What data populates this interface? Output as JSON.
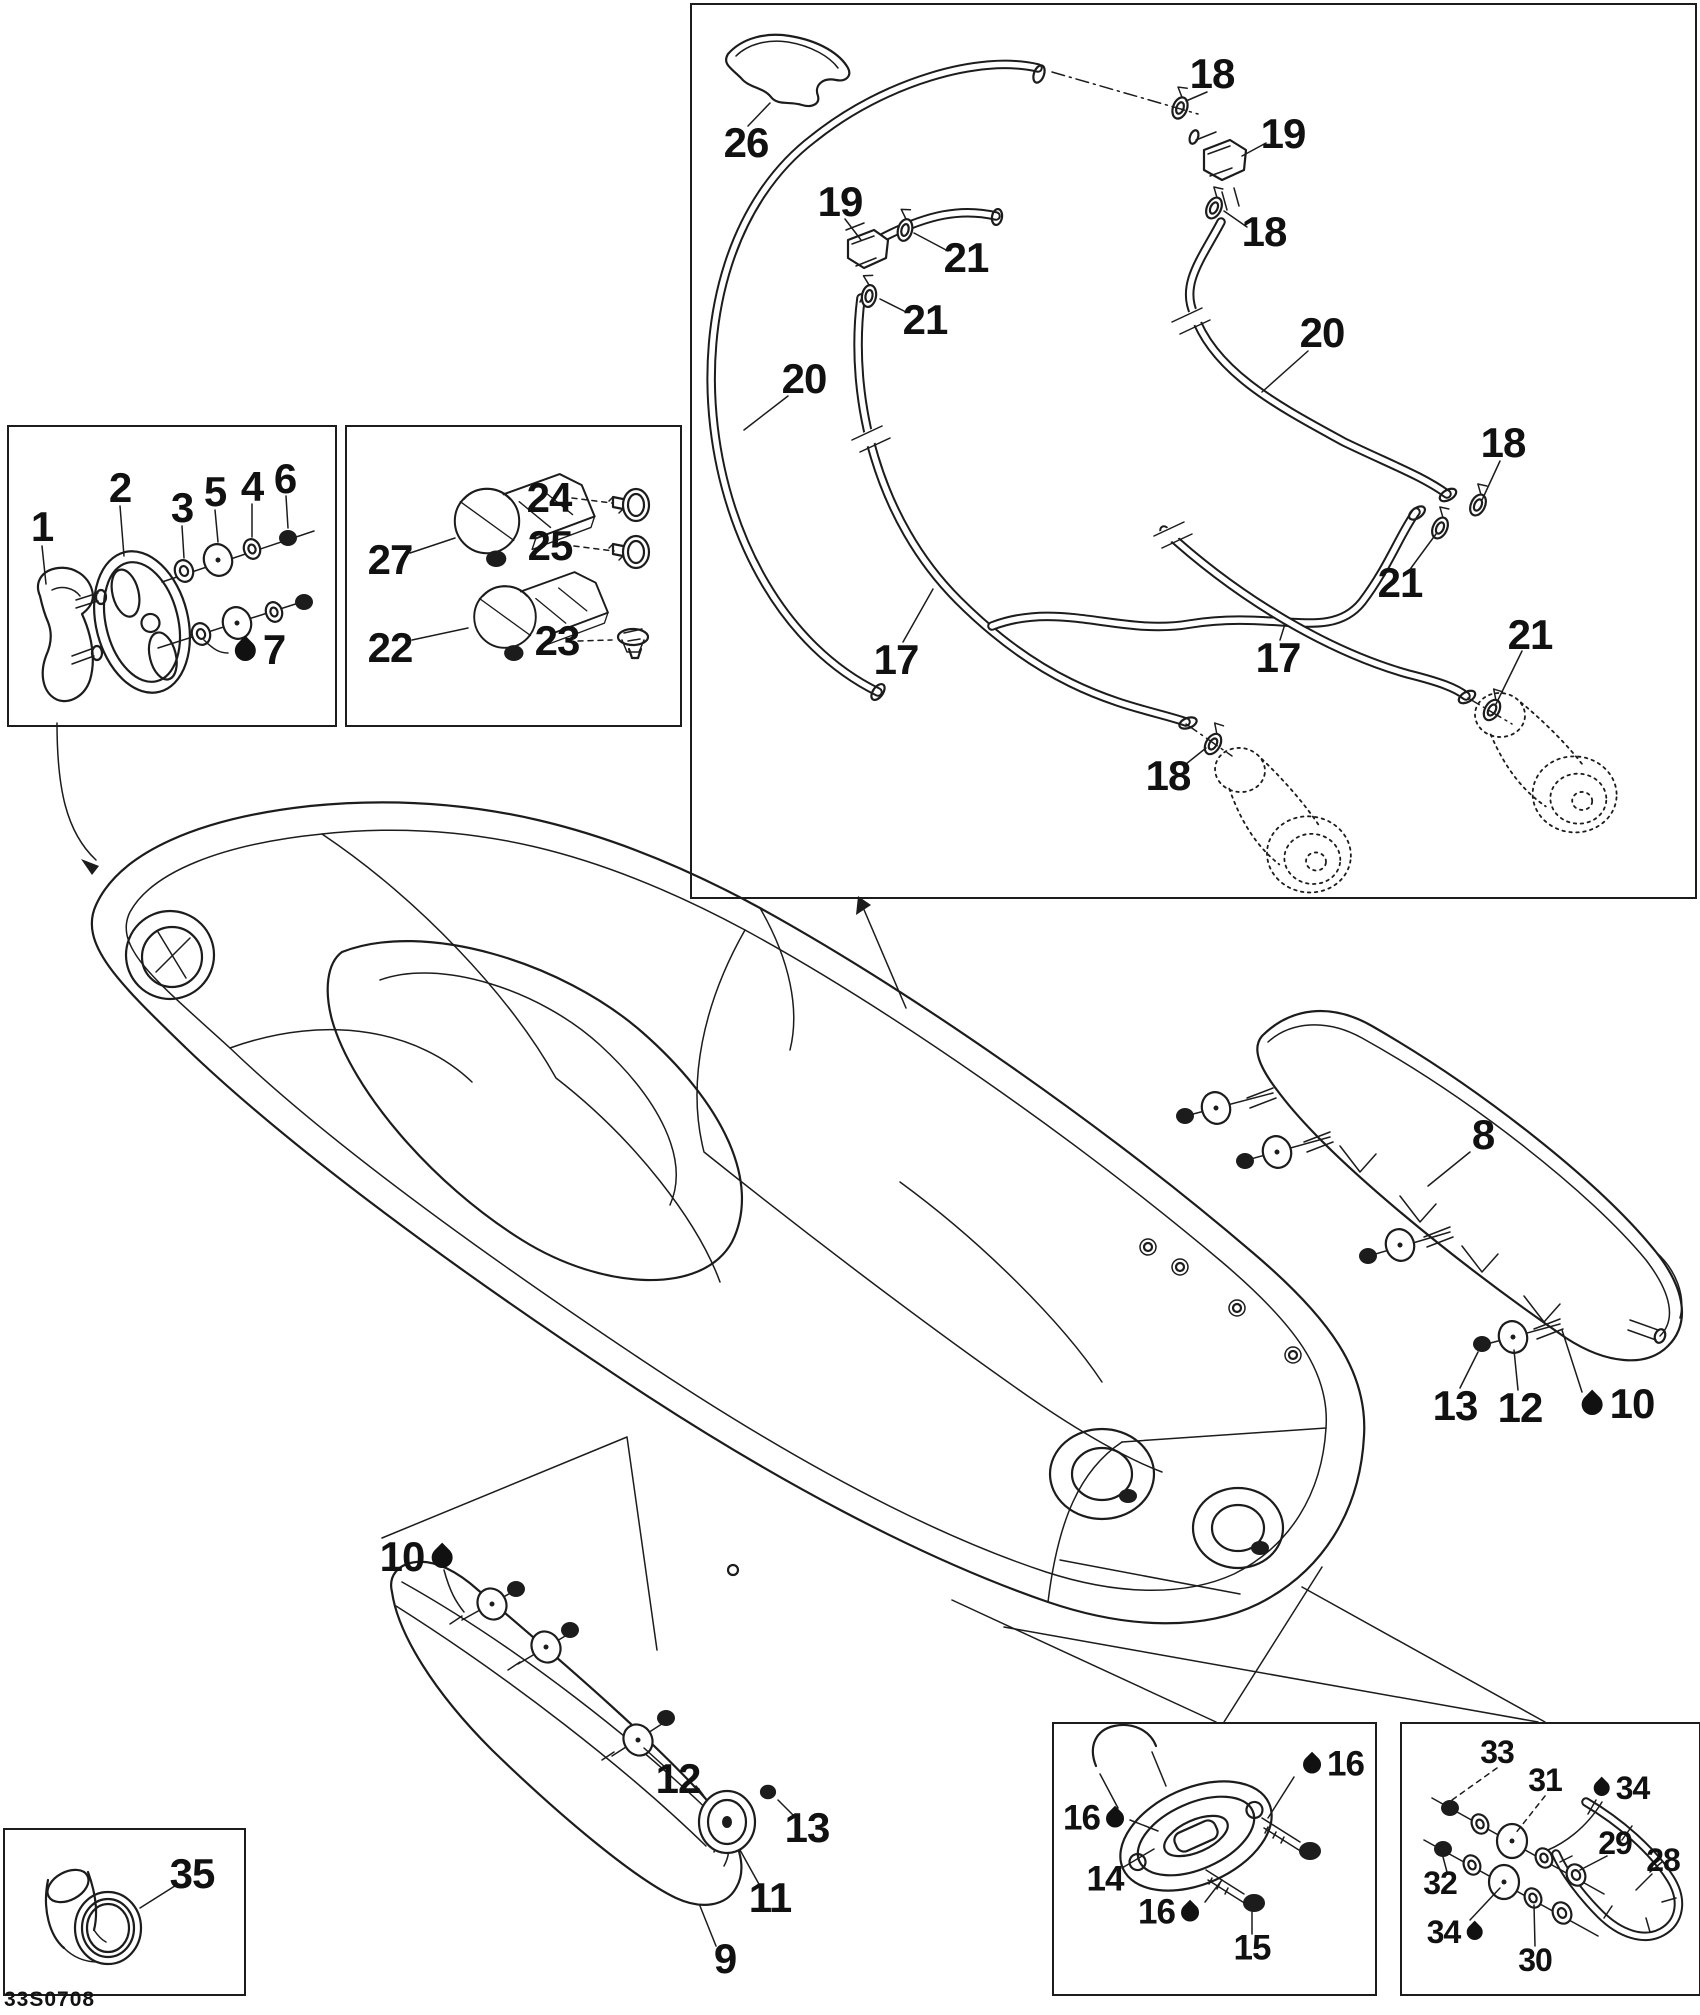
{
  "doc": {
    "code": "33S0708"
  },
  "colors": {
    "line": "#1c1c1c",
    "background": "#ffffff",
    "label": "#111111"
  },
  "legend": {
    "oil_drop_meaning": "lubricant-symbol"
  },
  "callouts": [
    {
      "label": "1",
      "x": 42,
      "y": 527,
      "size": "lg",
      "drop": "none"
    },
    {
      "label": "2",
      "x": 120,
      "y": 488,
      "size": "lg",
      "drop": "none"
    },
    {
      "label": "3",
      "x": 182,
      "y": 508,
      "size": "lg",
      "drop": "none"
    },
    {
      "label": "5",
      "x": 215,
      "y": 492,
      "size": "lg",
      "drop": "none"
    },
    {
      "label": "4",
      "x": 252,
      "y": 487,
      "size": "lg",
      "drop": "none"
    },
    {
      "label": "6",
      "x": 285,
      "y": 479,
      "size": "lg",
      "drop": "none"
    },
    {
      "label": "7",
      "x": 258,
      "y": 650,
      "size": "lg",
      "drop": "before"
    },
    {
      "label": "27",
      "x": 390,
      "y": 560,
      "size": "lg",
      "drop": "none"
    },
    {
      "label": "22",
      "x": 390,
      "y": 648,
      "size": "lg",
      "drop": "none"
    },
    {
      "label": "24",
      "x": 549,
      "y": 498,
      "size": "lg",
      "drop": "none"
    },
    {
      "label": "25",
      "x": 550,
      "y": 546,
      "size": "lg",
      "drop": "none"
    },
    {
      "label": "23",
      "x": 557,
      "y": 641,
      "size": "lg",
      "drop": "none"
    },
    {
      "label": "26",
      "x": 746,
      "y": 143,
      "size": "lg",
      "drop": "none"
    },
    {
      "label": "19",
      "x": 840,
      "y": 202,
      "size": "lg",
      "drop": "none"
    },
    {
      "label": "21",
      "x": 966,
      "y": 258,
      "size": "lg",
      "drop": "none"
    },
    {
      "label": "21",
      "x": 925,
      "y": 320,
      "size": "lg",
      "drop": "none"
    },
    {
      "label": "18",
      "x": 1212,
      "y": 74,
      "size": "lg",
      "drop": "none"
    },
    {
      "label": "19",
      "x": 1283,
      "y": 134,
      "size": "lg",
      "drop": "none"
    },
    {
      "label": "18",
      "x": 1264,
      "y": 232,
      "size": "lg",
      "drop": "none"
    },
    {
      "label": "20",
      "x": 804,
      "y": 379,
      "size": "lg",
      "drop": "none"
    },
    {
      "label": "20",
      "x": 1322,
      "y": 333,
      "size": "lg",
      "drop": "none"
    },
    {
      "label": "18",
      "x": 1503,
      "y": 443,
      "size": "lg",
      "drop": "none"
    },
    {
      "label": "21",
      "x": 1400,
      "y": 583,
      "size": "lg",
      "drop": "none"
    },
    {
      "label": "21",
      "x": 1530,
      "y": 635,
      "size": "lg",
      "drop": "none"
    },
    {
      "label": "17",
      "x": 896,
      "y": 660,
      "size": "lg",
      "drop": "none"
    },
    {
      "label": "17",
      "x": 1278,
      "y": 658,
      "size": "lg",
      "drop": "none"
    },
    {
      "label": "18",
      "x": 1168,
      "y": 776,
      "size": "lg",
      "drop": "none"
    },
    {
      "label": "8",
      "x": 1483,
      "y": 1135,
      "size": "lg",
      "drop": "none"
    },
    {
      "label": "13",
      "x": 1455,
      "y": 1406,
      "size": "lg",
      "drop": "none"
    },
    {
      "label": "12",
      "x": 1520,
      "y": 1408,
      "size": "lg",
      "drop": "none"
    },
    {
      "label": "10",
      "x": 1616,
      "y": 1404,
      "size": "lg",
      "drop": "before"
    },
    {
      "label": "10",
      "x": 418,
      "y": 1557,
      "size": "lg",
      "drop": "after"
    },
    {
      "label": "12",
      "x": 678,
      "y": 1779,
      "size": "lg",
      "drop": "none"
    },
    {
      "label": "13",
      "x": 807,
      "y": 1828,
      "size": "lg",
      "drop": "none"
    },
    {
      "label": "11",
      "x": 770,
      "y": 1898,
      "size": "lg",
      "drop": "none"
    },
    {
      "label": "9",
      "x": 725,
      "y": 1959,
      "size": "lg",
      "drop": "none"
    },
    {
      "label": "35",
      "x": 192,
      "y": 1874,
      "size": "lg",
      "drop": "none"
    },
    {
      "label": "16",
      "x": 1095,
      "y": 1818,
      "size": "md",
      "drop": "after"
    },
    {
      "label": "14",
      "x": 1105,
      "y": 1879,
      "size": "md",
      "drop": "none"
    },
    {
      "label": "16",
      "x": 1332,
      "y": 1764,
      "size": "md",
      "drop": "before"
    },
    {
      "label": "16",
      "x": 1170,
      "y": 1912,
      "size": "md",
      "drop": "after"
    },
    {
      "label": "15",
      "x": 1252,
      "y": 1948,
      "size": "md",
      "drop": "none"
    },
    {
      "label": "33",
      "x": 1497,
      "y": 1752,
      "size": "sm",
      "drop": "none"
    },
    {
      "label": "31",
      "x": 1545,
      "y": 1780,
      "size": "sm",
      "drop": "none"
    },
    {
      "label": "34",
      "x": 1620,
      "y": 1788,
      "size": "sm",
      "drop": "before"
    },
    {
      "label": "29",
      "x": 1615,
      "y": 1843,
      "size": "sm",
      "drop": "none"
    },
    {
      "label": "28",
      "x": 1663,
      "y": 1860,
      "size": "sm",
      "drop": "none"
    },
    {
      "label": "32",
      "x": 1440,
      "y": 1883,
      "size": "sm",
      "drop": "none"
    },
    {
      "label": "34",
      "x": 1456,
      "y": 1932,
      "size": "sm",
      "drop": "after"
    },
    {
      "label": "30",
      "x": 1535,
      "y": 1960,
      "size": "sm",
      "drop": "none"
    }
  ]
}
